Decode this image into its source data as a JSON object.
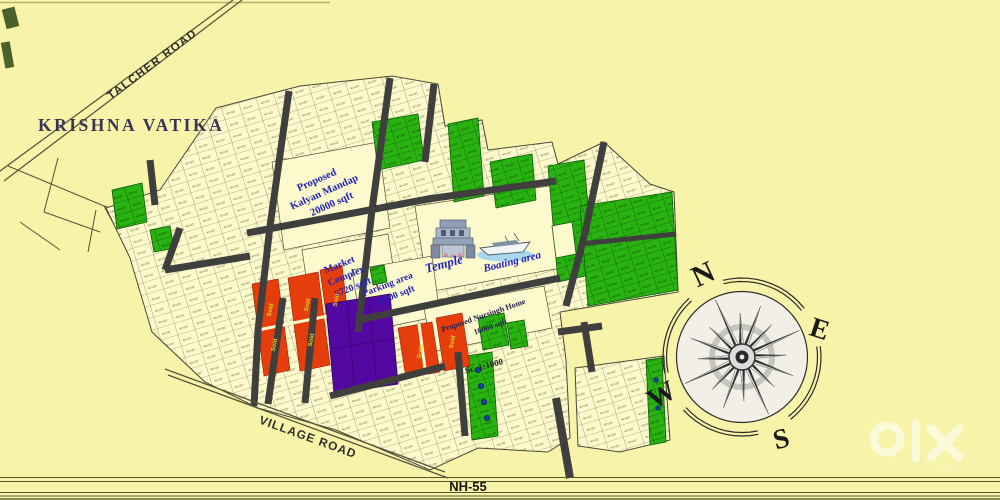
{
  "title": "KRISHNA VATIKA",
  "map": {
    "roads": {
      "talcher": "TALCHER ROAD",
      "village": "VILLAGE ROAD",
      "highway": "NH-55"
    },
    "areas": {
      "kalyan_line1": "Proposed",
      "kalyan_line2": "Kalyan Mandap",
      "kalyan_line3": "20000 sqft",
      "market_line1": "Market",
      "market_line2": "Complex",
      "market_line3": "6720 sqft",
      "parking_line1": "Parking area",
      "parking_line2": "11000 sqft",
      "nursing_line1": "Proposed Nursingh Home",
      "nursing_line2": "16000 sqft",
      "temple": "Temple",
      "boating": "Boating area",
      "scale": "Sc. 1:1000",
      "sold": "Sold",
      "plot_size_label": "40'x30'"
    },
    "colors": {
      "background": "#f7f4a9",
      "plot_available": "#fcf9cc",
      "plot_sold_green": "#29b310",
      "plot_sold_red": "#e63d0d",
      "plot_reserved_purple": "#5408a2",
      "road": "#3f3f3d",
      "label_blue": "#2424b4"
    }
  },
  "compass": {
    "north": "N",
    "east": "E",
    "south": "S",
    "west": "W"
  },
  "watermark": {
    "brand": "olx",
    "country": "INDIA"
  }
}
